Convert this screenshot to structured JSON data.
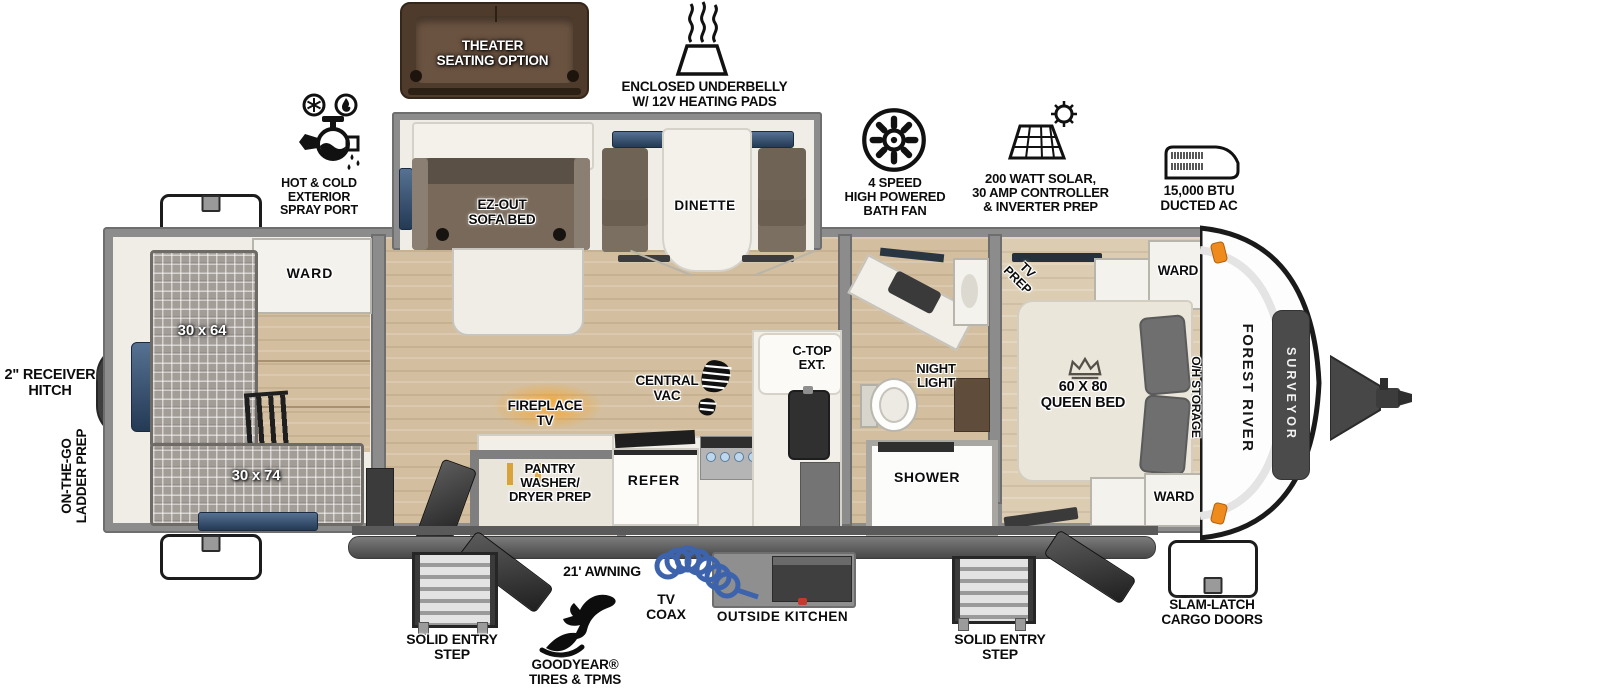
{
  "branding": {
    "make": "FOREST RIVER",
    "model": "SURVEYOR"
  },
  "callouts": {
    "theater_seating": "THEATER\nSEATING OPTION",
    "underbelly": "ENCLOSED UNDERBELLY\nW/ 12V HEATING PADS",
    "spray_port": "HOT & COLD EXTERIOR\nSPRAY PORT",
    "bath_fan": "4 SPEED\nHIGH POWERED\nBATH FAN",
    "solar": "200 WATT SOLAR,\n30 AMP CONTROLLER\n& INVERTER PREP",
    "ducted_ac": "15,000 BTU\nDUCTED AC",
    "receiver_hitch": "2\" RECEIVER\nHITCH",
    "ladder_prep": "ON-THE-GO\nLADDER PREP",
    "awning": "21' AWNING",
    "entry_step_left": "SOLID ENTRY\nSTEP",
    "entry_step_right": "SOLID ENTRY\nSTEP",
    "tires": "GOODYEAR®\nTIRES & TPMS",
    "tv_coax": "TV\nCOAX",
    "outside_kitchen": "OUTSIDE KITCHEN",
    "cargo_doors": "SLAM-LATCH\nCARGO DOORS"
  },
  "interior": {
    "ward_rear": "WARD",
    "bunk_upper": "30 x 64",
    "bunk_lower": "30 x 74",
    "sofa": "EZ-OUT\nSOFA BED",
    "dinette": "DINETTE",
    "fireplace": "FIREPLACE\nTV",
    "central_vac": "CENTRAL\nVAC",
    "ctop_ext": "C-TOP\nEXT.",
    "pantry": "PANTRY\nWASHER/\nDRYER PREP",
    "refer": "REFER",
    "night_light": "NIGHT\nLIGHT",
    "shower": "SHOWER",
    "tv_prep": "TV\nPREP",
    "ward_front_top": "WARD",
    "ward_front_bottom": "WARD",
    "queen_bed": "60 X 80\nQUEEN BED",
    "oh_storage": "O/H STORAGE"
  },
  "colors": {
    "wall": "#8c8c8c",
    "floor_wood": "#d3bf9f",
    "floor_light": "#f0ede6",
    "accent_orange": "#f59b1e",
    "window_blue": "#2c415f",
    "coax_blue": "#3c63ab",
    "couch_brown": "#5a4638"
  }
}
